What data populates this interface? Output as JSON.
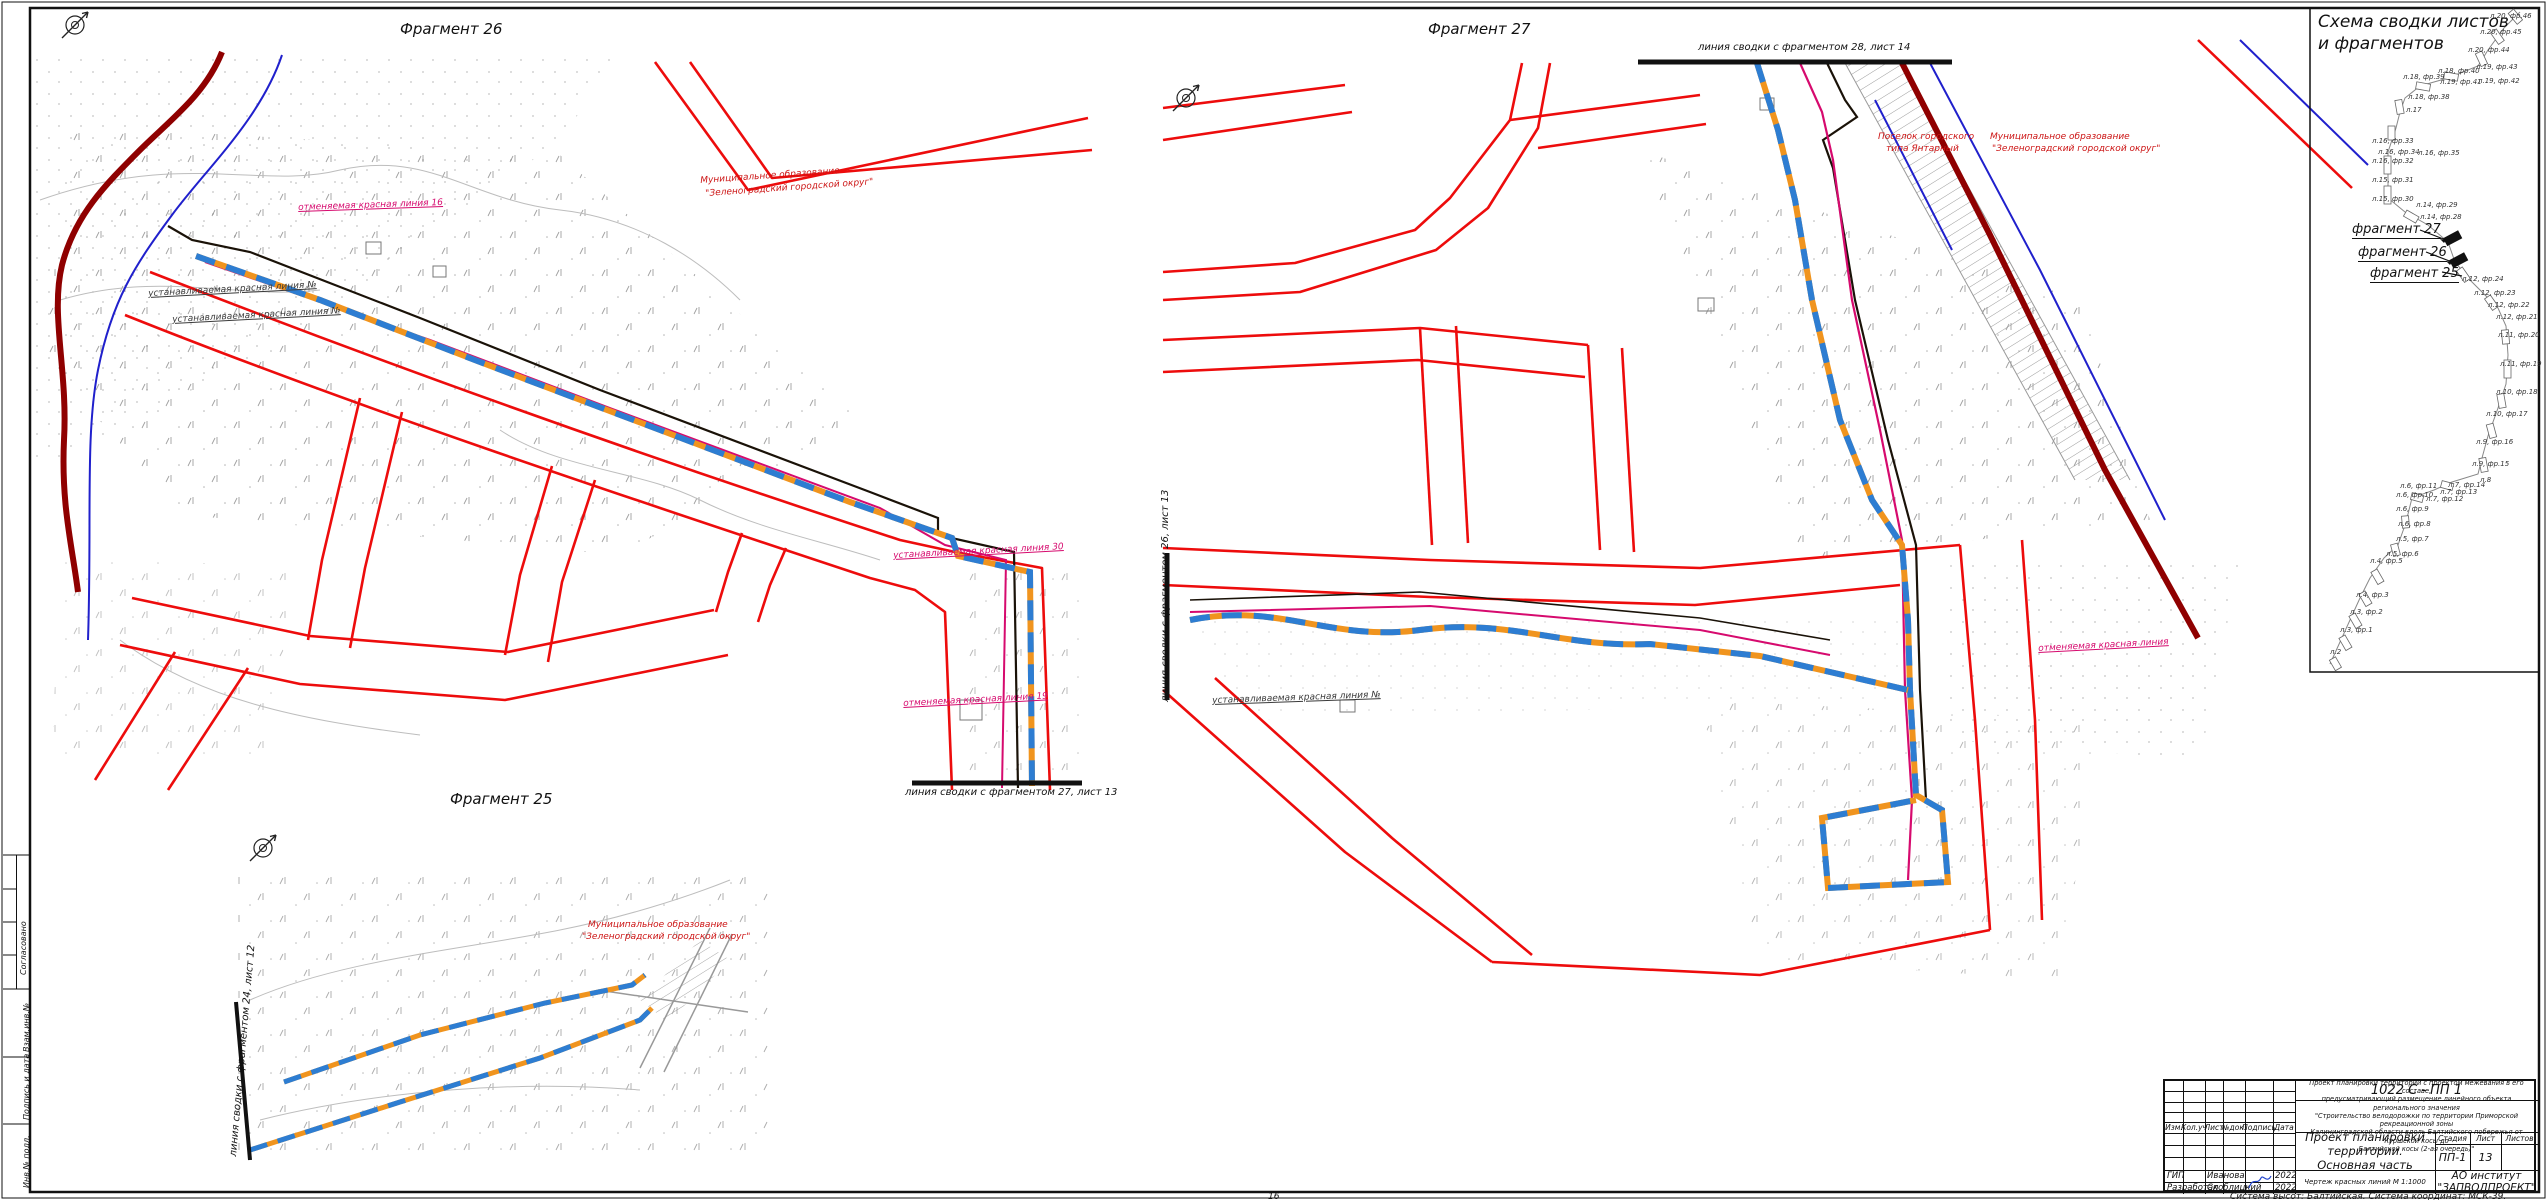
{
  "sheet": {
    "page_number": "16",
    "coord_note": "Система высот: Балтийская. Система координат: МСК-39.",
    "frame_labels": {
      "agreed": "Согласовано",
      "vzam": "Взам.инв.№",
      "podp": "Подпись и дата",
      "inv": "Инв.№ подл."
    }
  },
  "fragments": {
    "f26": {
      "title": "Фрагмент 26"
    },
    "f27": {
      "title": "Фрагмент 27"
    },
    "f25": {
      "title": "Фрагмент 25"
    }
  },
  "key_panel": {
    "title_line1": "Схема сводки листов",
    "title_line2": "и фрагментов",
    "callouts": [
      {
        "text": "фрагмент 27",
        "x": 2352,
        "y": 222
      },
      {
        "text": "фрагмент 26",
        "x": 2358,
        "y": 245
      },
      {
        "text": "фрагмент 25",
        "x": 2370,
        "y": 266
      }
    ],
    "items": [
      {
        "text": "л.20, фр.46",
        "x": 2490,
        "y": 12
      },
      {
        "text": "л.20, фр.45",
        "x": 2480,
        "y": 28
      },
      {
        "text": "л.20, фр.44",
        "x": 2468,
        "y": 46
      },
      {
        "text": "л.19, фр.43",
        "x": 2476,
        "y": 63
      },
      {
        "text": "л.18, фр.40",
        "x": 2438,
        "y": 67
      },
      {
        "text": "л.18, фр.39",
        "x": 2403,
        "y": 73
      },
      {
        "text": "л.19, фр.41",
        "x": 2440,
        "y": 78
      },
      {
        "text": "л.19, фр.42",
        "x": 2478,
        "y": 77
      },
      {
        "text": "л.18, фр.38",
        "x": 2408,
        "y": 93
      },
      {
        "text": "л.17",
        "x": 2406,
        "y": 106
      },
      {
        "text": "л.16, фр.33",
        "x": 2372,
        "y": 137
      },
      {
        "text": "л.16, фр.34",
        "x": 2378,
        "y": 148
      },
      {
        "text": "л.16, фр.35",
        "x": 2418,
        "y": 149
      },
      {
        "text": "л.16, фр.32",
        "x": 2372,
        "y": 157
      },
      {
        "text": "л.15, фр.31",
        "x": 2372,
        "y": 176
      },
      {
        "text": "л.15, фр.30",
        "x": 2372,
        "y": 195
      },
      {
        "text": "л.14, фр.29",
        "x": 2416,
        "y": 201
      },
      {
        "text": "л.14, фр.28",
        "x": 2420,
        "y": 213
      },
      {
        "text": "л.12, фр.24",
        "x": 2462,
        "y": 275
      },
      {
        "text": "л.12, фр.23",
        "x": 2474,
        "y": 289
      },
      {
        "text": "л.12, фр.22",
        "x": 2488,
        "y": 301
      },
      {
        "text": "л.12, фр.21",
        "x": 2496,
        "y": 313
      },
      {
        "text": "л.11, фр.20",
        "x": 2498,
        "y": 331
      },
      {
        "text": "л.11, фр.19",
        "x": 2500,
        "y": 360
      },
      {
        "text": "л.10, фр.18",
        "x": 2496,
        "y": 388
      },
      {
        "text": "л.10, фр.17",
        "x": 2486,
        "y": 410
      },
      {
        "text": "л.9, фр.16",
        "x": 2476,
        "y": 438
      },
      {
        "text": "л.9, фр.15",
        "x": 2472,
        "y": 460
      },
      {
        "text": "л.8",
        "x": 2480,
        "y": 476
      },
      {
        "text": "л.7, фр.14",
        "x": 2448,
        "y": 481
      },
      {
        "text": "л.6, фр.11",
        "x": 2400,
        "y": 482
      },
      {
        "text": "л.7, фр.13",
        "x": 2440,
        "y": 488
      },
      {
        "text": "л.6, фр.10",
        "x": 2396,
        "y": 491
      },
      {
        "text": "л.7, фр.12",
        "x": 2426,
        "y": 495
      },
      {
        "text": "л.6, фр.9",
        "x": 2396,
        "y": 505
      },
      {
        "text": "л.6, фр.8",
        "x": 2398,
        "y": 520
      },
      {
        "text": "л.5, фр.7",
        "x": 2396,
        "y": 535
      },
      {
        "text": "л.5, фр.6",
        "x": 2386,
        "y": 550
      },
      {
        "text": "л.4, фр.5",
        "x": 2370,
        "y": 557
      },
      {
        "text": "л.4, фр.3",
        "x": 2356,
        "y": 591
      },
      {
        "text": "л.3, фр.2",
        "x": 2350,
        "y": 608
      },
      {
        "text": "л.3, фр.1",
        "x": 2340,
        "y": 626
      },
      {
        "text": "л.2",
        "x": 2330,
        "y": 648
      }
    ]
  },
  "map_labels": [
    {
      "text": "Муниципальное образование",
      "x": 700,
      "y": 176,
      "c": "red",
      "r": -4
    },
    {
      "text": "\"Зеленоградский городской округ\"",
      "x": 705,
      "y": 189,
      "c": "red",
      "r": -4
    },
    {
      "text": "отменяемая красная линия 16",
      "x": 298,
      "y": 203,
      "c": "mag",
      "r": -2,
      "u": 1
    },
    {
      "text": "устанавливаемая красная линия №",
      "x": 148,
      "y": 289,
      "c": "dark",
      "r": -3,
      "u": 1
    },
    {
      "text": "устанавливаемая красная линия №",
      "x": 172,
      "y": 315,
      "c": "dark",
      "r": -3,
      "u": 1
    },
    {
      "text": "устанавливаемая красная линия 30",
      "x": 893,
      "y": 551,
      "c": "mag",
      "r": -3,
      "u": 1
    },
    {
      "text": "отменяемая красная линия 19",
      "x": 903,
      "y": 699,
      "c": "mag",
      "r": -3,
      "u": 1
    },
    {
      "text": "линия сводки с фрагментом 27, лист 13",
      "x": 905,
      "y": 787,
      "c": "blk",
      "s": 10
    },
    {
      "text": "линия сводки с фрагментом 28, лист 14",
      "x": 1698,
      "y": 42,
      "c": "blk",
      "s": 10
    },
    {
      "text": "линия сводки с фрагментом 26, лист 13",
      "x": 1160,
      "y": 702,
      "c": "blk",
      "s": 10,
      "r": -90
    },
    {
      "text": "Поселок городского",
      "x": 1878,
      "y": 132,
      "c": "red"
    },
    {
      "text": "типа Янтарный",
      "x": 1886,
      "y": 144,
      "c": "red"
    },
    {
      "text": "Муниципальное образование",
      "x": 1990,
      "y": 132,
      "c": "red"
    },
    {
      "text": "\"Зеленоградский городской округ\"",
      "x": 1992,
      "y": 144,
      "c": "red"
    },
    {
      "text": "отменяемая красная линия",
      "x": 2038,
      "y": 644,
      "c": "mag",
      "r": -3,
      "u": 1
    },
    {
      "text": "устанавливаемая красная линия №",
      "x": 1212,
      "y": 696,
      "c": "dark",
      "r": -2,
      "u": 1
    },
    {
      "text": "Муниципальное образование",
      "x": 588,
      "y": 920,
      "c": "red"
    },
    {
      "text": "\"Зеленоградский городской округ\"",
      "x": 582,
      "y": 932,
      "c": "red"
    },
    {
      "text": "линия сводки с фрагментом 24, лист 12",
      "x": 228,
      "y": 1156,
      "c": "blk",
      "s": 10,
      "r": -85
    }
  ],
  "stamp": {
    "doc_number": "1022 С - ПП 1",
    "description_lines": [
      "Проект планировки территории с проектом межевания в его составе,",
      "предусматривающий размещение линейного объекта регионального значения",
      "\"Строительство велодорожки по территории Приморской рекреационной зоны",
      "Калининградской области вдоль Балтийского побережья от Куршской косы до",
      "Балтийской косы (2-ая очередь)\""
    ],
    "title_line1": "Проект планировки территории.",
    "title_line2": "Основная часть",
    "stage_label": "Стадия",
    "sheet_label": "Лист",
    "sheets_label": "Листов",
    "stage": "ПП-1",
    "sheet_no": "13",
    "sheets_total": "",
    "drawing_name": "Чертеж красных линий М 1:1000",
    "org_line1": "АО институт",
    "org_line2": "\"ЗАПВОДПРОЕКТ\"",
    "rev_cols": [
      "Изм.",
      "Кол.уч",
      "Лист",
      "№док.",
      "Подпись",
      "Дата"
    ],
    "roles": [
      {
        "role": "ГИП",
        "name": "Иванова",
        "date": "2022"
      },
      {
        "role": "Разработал",
        "name": "Скоблицкий",
        "date": "2022"
      }
    ]
  }
}
